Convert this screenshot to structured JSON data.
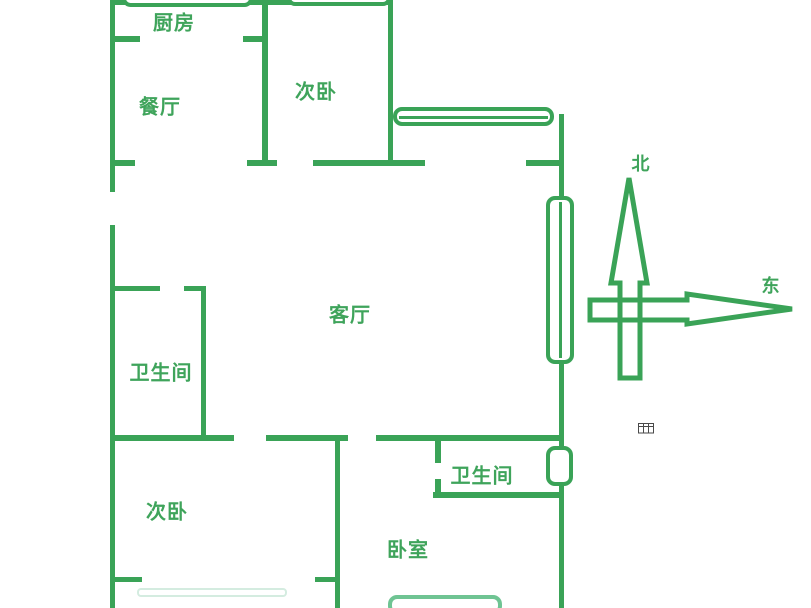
{
  "diagram": {
    "type": "floor-plan",
    "description": "green line apartment floor plan"
  },
  "rooms": {
    "kitchen": {
      "label": "厨房"
    },
    "dining": {
      "label": "餐厅"
    },
    "bedroom_top": {
      "label": "次卧"
    },
    "living": {
      "label": "客厅"
    },
    "bathroom_left": {
      "label": "卫生间"
    },
    "bedroom_left": {
      "label": "次卧"
    },
    "bathroom_bottom": {
      "label": "卫生间"
    },
    "bedroom_main": {
      "label": "卧室"
    }
  },
  "compass": {
    "north_label": "北",
    "east_label": "东"
  },
  "colors": {
    "wall_green": "#3aa357",
    "label_green": "#3fa45b",
    "window_light_green": "#6fc493",
    "window_faint_green": "#d4ece0",
    "table_icon_gray": "#4a4a4a"
  },
  "icons": {
    "table": "table-grid-icon"
  }
}
